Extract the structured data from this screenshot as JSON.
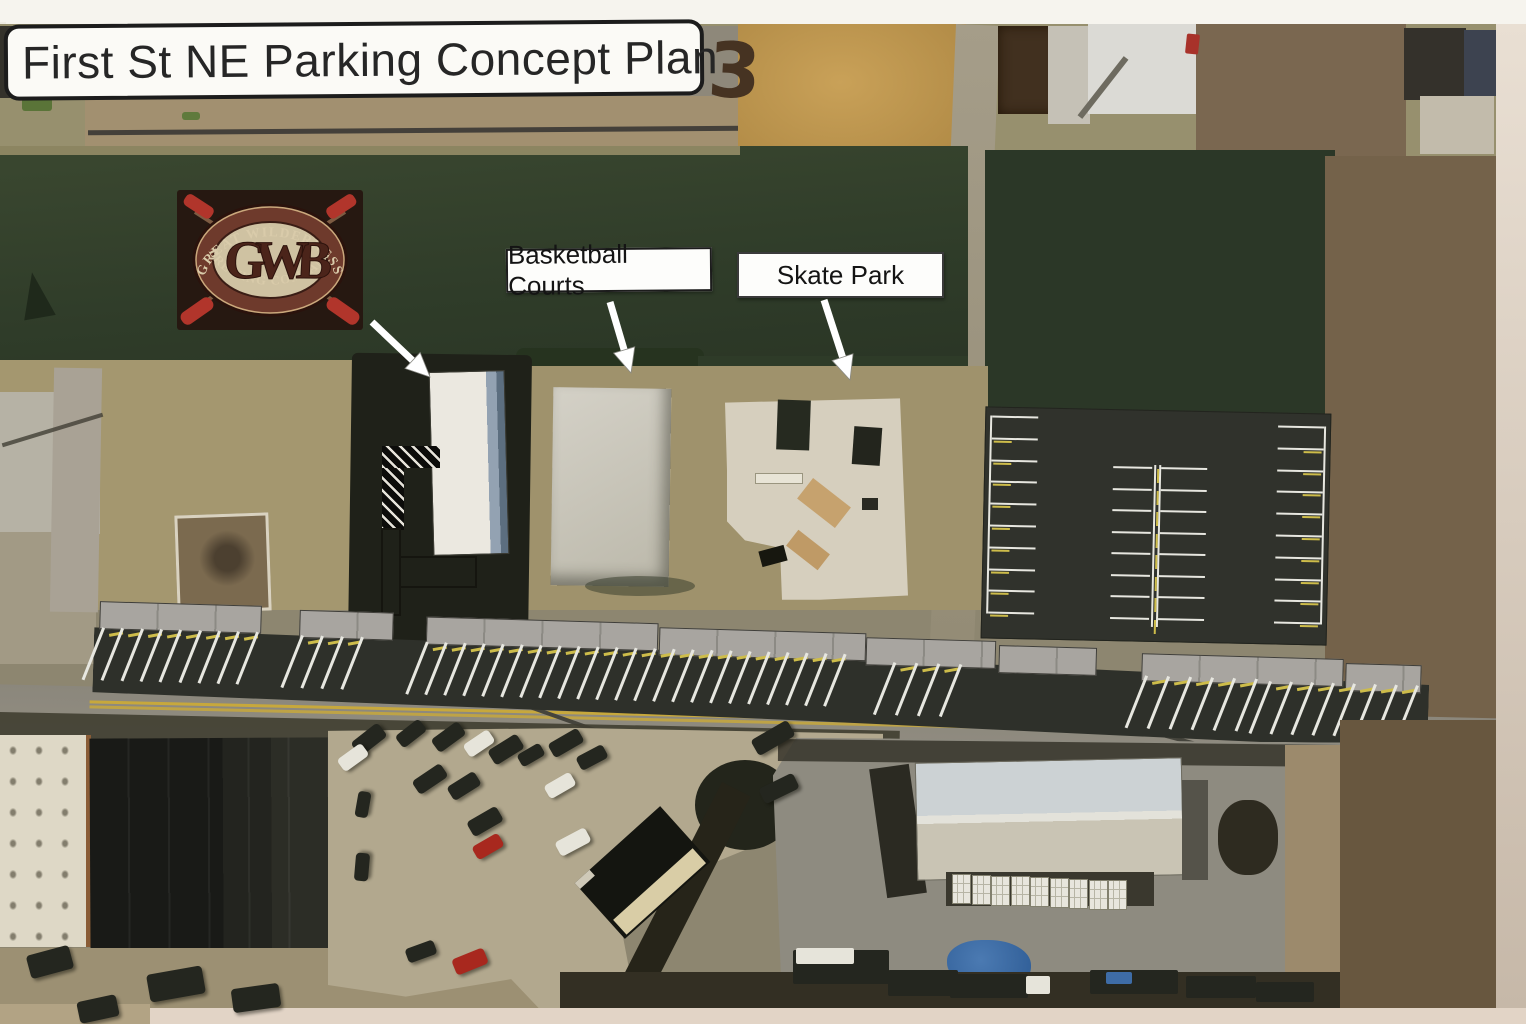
{
  "title": {
    "text": "First St NE Parking Concept Plan",
    "page_number": "3"
  },
  "annotations": {
    "basketball_label": "Basketball Courts",
    "skate_label": "Skate Park"
  },
  "logo": {
    "arc_top": "GREAT WILDERNESS",
    "monogram": "GWB",
    "arc_bottom": "BREWING COMPANY"
  },
  "colors": {
    "asphalt": "#30322c",
    "stall_line": "#e7e7e0",
    "stall_accent": "#cdbc4a",
    "road": "#8f8b80",
    "road_centerline": "#c7a83c",
    "sidewalk": "#a8a5a0",
    "field_green": "#33402c",
    "label_bg": "#fdfdfb",
    "label_border": "#1c1c1c",
    "logo_red": "#b1352b",
    "car_dark": "#24261f",
    "car_white": "#e6e4da",
    "car_red": "#a8281e",
    "car_blue": "#3e6ca6"
  },
  "scene": {
    "arrows": [
      [
        372,
        322,
        430,
        377
      ],
      [
        610,
        302,
        631,
        373
      ],
      [
        824,
        300,
        850,
        380
      ]
    ],
    "sidewalk_segments": [
      [
        5,
        0,
        160
      ],
      [
        205,
        3,
        92
      ],
      [
        332,
        6,
        230
      ],
      [
        565,
        10,
        205
      ],
      [
        772,
        14,
        128
      ],
      [
        905,
        18,
        96
      ],
      [
        1048,
        22,
        200
      ],
      [
        1252,
        26,
        74
      ]
    ],
    "street_stall_groups": [
      {
        "x": 8,
        "y": 26,
        "n": 9,
        "dx": 19.3
      },
      {
        "x": 207,
        "y": 28,
        "n": 4,
        "dx": 20
      },
      {
        "x": 332,
        "y": 31,
        "n": 23,
        "dx": 19
      },
      {
        "x": 800,
        "y": 38,
        "n": 4,
        "dx": 22
      },
      {
        "x": 1052,
        "y": 44,
        "n": 6,
        "dx": 22
      },
      {
        "x": 1176,
        "y": 46,
        "n": 8,
        "dx": 21
      }
    ],
    "lot": {
      "left": {
        "vx": 4,
        "x": 6,
        "len": 46,
        "y0": 8,
        "dy": 21.8,
        "rows": 10
      },
      "right": {
        "vx": 338,
        "x": 292,
        "len": 46,
        "y0": 12,
        "dy": 21.8,
        "rows": 10
      },
      "center": {
        "vx": 169,
        "vy0": 54,
        "vy1": 216,
        "lx": 128,
        "llen": 39,
        "rx": 176,
        "rlen": 46,
        "y0": 56,
        "dy": 21.5,
        "rows": 8
      }
    },
    "cars": [
      [
        352,
        731,
        34,
        17,
        -38,
        "d"
      ],
      [
        396,
        726,
        30,
        15,
        -38,
        "d"
      ],
      [
        432,
        729,
        33,
        16,
        -36,
        "d"
      ],
      [
        464,
        736,
        30,
        15,
        -34,
        "w"
      ],
      [
        489,
        741,
        34,
        17,
        -32,
        "d"
      ],
      [
        518,
        748,
        26,
        14,
        -30,
        "d"
      ],
      [
        549,
        735,
        34,
        16,
        -30,
        "d"
      ],
      [
        577,
        750,
        30,
        15,
        -28,
        "d"
      ],
      [
        752,
        729,
        42,
        18,
        -30,
        "d"
      ],
      [
        760,
        780,
        38,
        17,
        -26,
        "d"
      ],
      [
        413,
        771,
        34,
        16,
        -34,
        "d"
      ],
      [
        448,
        778,
        32,
        16,
        -32,
        "d"
      ],
      [
        468,
        813,
        34,
        17,
        -30,
        "d"
      ],
      [
        473,
        839,
        30,
        15,
        -30,
        "r"
      ],
      [
        545,
        778,
        30,
        15,
        -30,
        "w"
      ],
      [
        556,
        834,
        34,
        16,
        -28,
        "w"
      ],
      [
        350,
        798,
        26,
        13,
        -80,
        "d"
      ],
      [
        348,
        860,
        28,
        14,
        -85,
        "d"
      ],
      [
        453,
        953,
        34,
        17,
        -22,
        "r"
      ],
      [
        406,
        944,
        30,
        15,
        -20,
        "d"
      ],
      [
        338,
        750,
        30,
        15,
        -36,
        "w"
      ],
      [
        28,
        950,
        44,
        24,
        -15,
        "d"
      ],
      [
        148,
        970,
        56,
        28,
        -10,
        "d"
      ],
      [
        232,
        986,
        48,
        24,
        -8,
        "d"
      ],
      [
        78,
        998,
        40,
        22,
        -12,
        "d"
      ]
    ],
    "trucks": [
      [
        793,
        950,
        96,
        34,
        "d"
      ],
      [
        888,
        970,
        70,
        26,
        "d"
      ],
      [
        950,
        974,
        78,
        24,
        "d"
      ],
      [
        1090,
        970,
        88,
        24,
        "d"
      ],
      [
        1186,
        976,
        70,
        22,
        "d"
      ],
      [
        1256,
        982,
        58,
        20,
        "d"
      ],
      [
        796,
        948,
        58,
        16,
        "w"
      ],
      [
        1026,
        976,
        24,
        18,
        "w"
      ],
      [
        1106,
        972,
        26,
        12,
        "b"
      ]
    ],
    "crates": {
      "x0": 952,
      "y0": 874,
      "n": 9,
      "w": 17,
      "h": 28,
      "dx": 19.5
    }
  }
}
